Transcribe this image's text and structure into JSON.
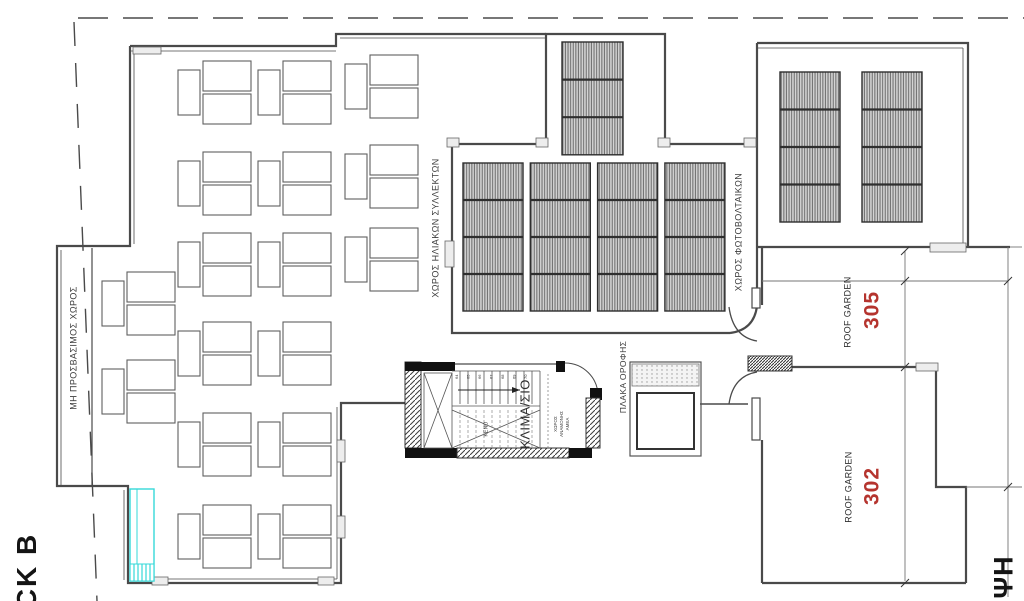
{
  "labels": {
    "solar_collectors": "ΧΩΡΟΣ ΗΛΙΑΚΩΝ ΣΥΛΛΕΚΤΩΝ",
    "photovoltaics": "ΧΩΡΟΣ ΦΩΤΟΒΟΛΤΑΙΚΩΝ",
    "non_accessible": "ΜΗ ΠΡΟΣΒΑΣΙΜΟΣ ΧΩΡΟΣ",
    "stairwell": "ΚΛΙΜΑ/ΣΙΟ",
    "roof_slab": "ΠΛΑΚΑ ΟΡΟΦΗΣ",
    "void": "ΚΕΝΟ",
    "amea_waiting_lines": [
      "ΧΩΡΟΣ",
      "ΑΝΑΜΟΝΗΣ",
      "ΑΜΕΑ"
    ],
    "block_partial": "CK B",
    "plan_partial": "ΨΗ"
  },
  "roof_gardens": [
    {
      "name": "ROOF GARDEN",
      "number": "305"
    },
    {
      "name": "ROOF GARDEN",
      "number": "302"
    }
  ],
  "colors": {
    "accent_red": "#b5342e",
    "highlight_cyan": "#35d8d8",
    "wall_line": "#4a4a4a"
  },
  "stair": {
    "step_numbers": [
      "64",
      "65",
      "66",
      "67",
      "68",
      "69",
      "70"
    ],
    "upper_treads": 10,
    "lower_treads": 10
  },
  "plan_geometry": {
    "panel_grids": [
      {
        "name": "solar-collector-field",
        "x": 463,
        "y": 163,
        "cols": 4,
        "rows": 4,
        "cell_w": 60,
        "cell_h": 37,
        "gap_x": 7.3
      },
      {
        "name": "bay-panel-stack",
        "x": 562,
        "y": 42,
        "cols": 1,
        "rows": 3,
        "cell_w": 61,
        "cell_h": 37.6,
        "gap_x": 0
      },
      {
        "name": "photovoltaic-field",
        "x": 780,
        "y": 72,
        "cols": 2,
        "rows": 4,
        "cell_w": 60,
        "cell_h": 37.5,
        "gap_x": 22
      }
    ],
    "sunbed_groups": [
      [
        178,
        61
      ],
      [
        258,
        61
      ],
      [
        345,
        55
      ],
      [
        178,
        152
      ],
      [
        258,
        152
      ],
      [
        345,
        145
      ],
      [
        178,
        233
      ],
      [
        258,
        233
      ],
      [
        345,
        228
      ],
      [
        178,
        322
      ],
      [
        258,
        322
      ],
      [
        178,
        413
      ],
      [
        258,
        413
      ],
      [
        178,
        505
      ],
      [
        258,
        505
      ],
      [
        102,
        272
      ],
      [
        102,
        360
      ]
    ]
  }
}
